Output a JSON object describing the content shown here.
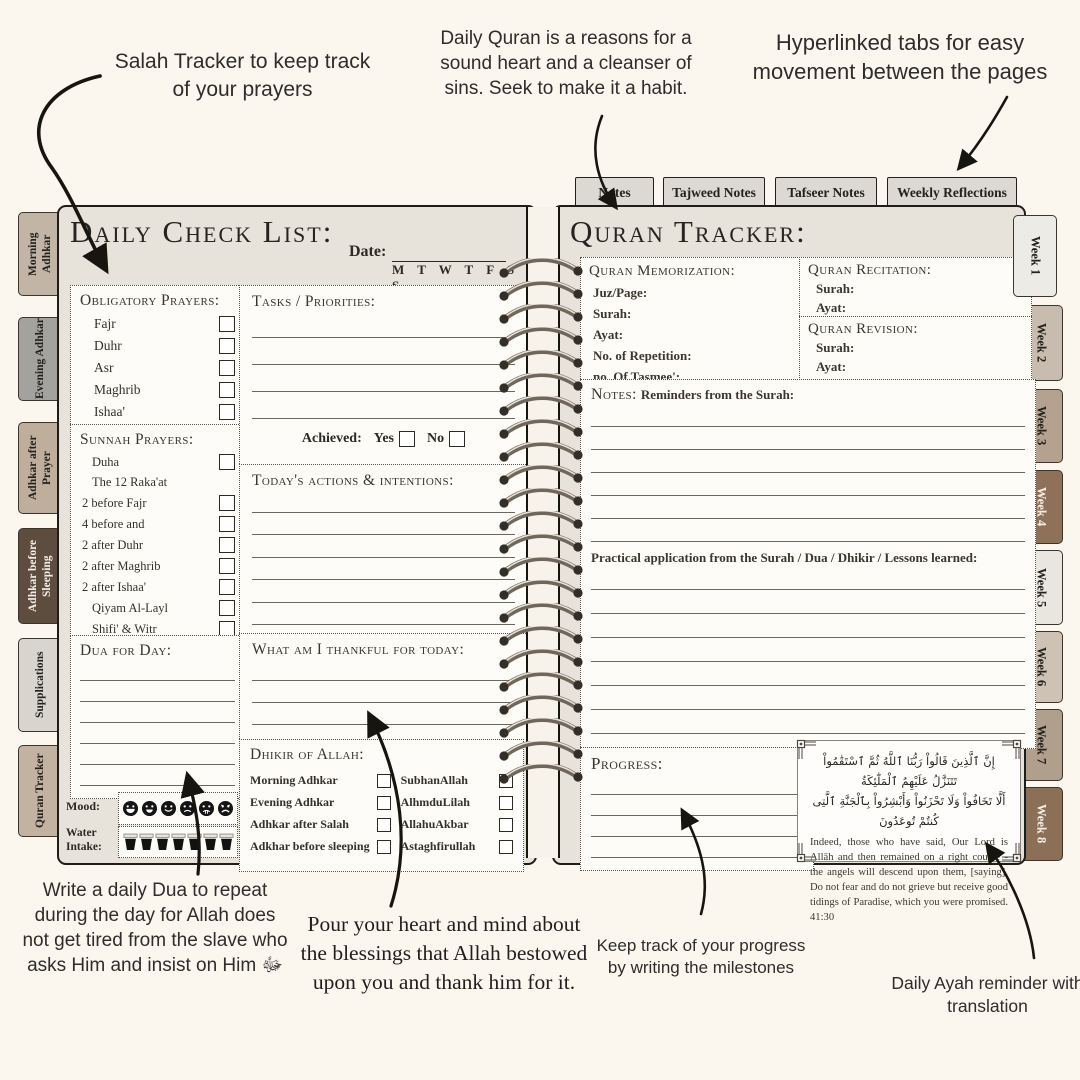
{
  "colors": {
    "background": "#fbf7ef",
    "page": "#e7e3db",
    "paper": "#fdfcf9",
    "ink": "#2d2a24",
    "tab_gray": "#dcd9d3"
  },
  "annotations": {
    "salah_tracker": "Salah Tracker to keep track of your prayers",
    "daily_quran": "Daily Quran is a reasons for a sound heart and a cleanser of sins. Seek to make it a habit.",
    "hyperlinked_tabs": "Hyperlinked tabs for easy movement between the pages",
    "daily_dua": "Write a daily Dua to repeat during the day for Allah does not get tired from the slave who asks Him and insist on Him ﷻ",
    "thankful": "Pour your heart and mind about the blessings that Allah bestowed upon you and thank him for it.",
    "progress": "Keep track of your progress by writing the milestones",
    "daily_ayah": "Daily Ayah reminder with translation"
  },
  "top_tabs": [
    "Notes",
    "Tajweed Notes",
    "Tafseer Notes",
    "Weekly Reflections"
  ],
  "left_tabs": [
    {
      "label": "Morning Adhkar",
      "color": "#c3b5a6",
      "text_color": "#23211c"
    },
    {
      "label": "Evening Adhkar",
      "color": "#a3a29e",
      "text_color": "#23211c"
    },
    {
      "label": "Adhkar after Prayer",
      "color": "#c0ae9c",
      "text_color": "#23211c"
    },
    {
      "label": "Adhkar before Sleeping",
      "color": "#5e4c3e",
      "text_color": "#f3efe8"
    },
    {
      "label": "Supplications",
      "color": "#d8d5cf",
      "text_color": "#23211c"
    },
    {
      "label": "Quran Tracker",
      "color": "#c3b2a1",
      "text_color": "#23211c"
    }
  ],
  "week_tabs": [
    {
      "label": "Week 1",
      "color": "#edebe5",
      "text_color": "#23211c"
    },
    {
      "label": "Week 2",
      "color": "#c8bcae",
      "text_color": "#23211c"
    },
    {
      "label": "Week 3",
      "color": "#b5a190",
      "text_color": "#23211c"
    },
    {
      "label": "Week 4",
      "color": "#8f7159",
      "text_color": "#f3efe8"
    },
    {
      "label": "Week 5",
      "color": "#e9e6e0",
      "text_color": "#23211c"
    },
    {
      "label": "Week 6",
      "color": "#cdc2b4",
      "text_color": "#23211c"
    },
    {
      "label": "Week 7",
      "color": "#b19f8d",
      "text_color": "#23211c"
    },
    {
      "label": "Week 8",
      "color": "#8c6f57",
      "text_color": "#f3efe8"
    }
  ],
  "left_page": {
    "title": "Daily Check List:",
    "date_label": "Date:",
    "days": "M T W T F S S",
    "obligatory": {
      "title": "Obligatory Prayers:",
      "items": [
        "Fajr",
        "Duhr",
        "Asr",
        "Maghrib",
        "Ishaa'"
      ]
    },
    "sunnah": {
      "title": "Sunnah Prayers:",
      "items": [
        "Duha",
        "The 12 Raka'at",
        "2 before Fajr",
        "4 before  and",
        "2 after Duhr",
        "2 after Maghrib",
        "2 after Ishaa'",
        "Qiyam Al-Layl",
        "Shifi' & Witr"
      ]
    },
    "dua_title": "Dua for Day:",
    "mood_label": "Mood:",
    "water_label": "Water Intake:",
    "tasks": {
      "title": "Tasks / Priorities:",
      "achieved_label": "Achieved:",
      "yes_label": "Yes",
      "no_label": "No"
    },
    "actions_title": "Today's actions & intentions:",
    "thankful_title": "What am I thankful for today:",
    "dhikir": {
      "title": "Dhikir of Allah:",
      "left": [
        "Morning Adhkar",
        "Evening Adhkar",
        "Adhkar after Salah",
        "Adkhar before sleeping"
      ],
      "right": [
        "SubhanAllah",
        "AlhmduLilah",
        "AllahuAkbar",
        "Astaghfirullah"
      ]
    }
  },
  "right_page": {
    "title": "Quran Tracker:",
    "memorization": {
      "title": "Quran Memorization:",
      "fields": [
        "Juz/Page:",
        "Surah:",
        "Ayat:",
        "No. of Repetition:",
        "no. Of Tasmee':"
      ]
    },
    "recitation": {
      "title": "Quran Recitation:",
      "fields": [
        "Surah:",
        "Ayat:"
      ]
    },
    "revision": {
      "title": "Quran Revision:",
      "fields": [
        "Surah:",
        "Ayat:"
      ]
    },
    "notes": {
      "title": "Notes:",
      "subtitle": "Reminders from the Surah:",
      "practical": "Practical application from the Surah / Dua / Dhikir  / Lessons learned:"
    },
    "progress_title": "Progress:",
    "ayah_box": {
      "arabic_line1": "إِنَّ ٱلَّذِينَ قَالُواْ رَبُّنَا ٱللَّهُ ثُمَّ ٱسْتَقَٰمُواْ تَتَنَزَّلُ عَلَيْهِمُ ٱلْمَلَٰٓئِكَةُ",
      "arabic_line2": "أَلَّا تَخَافُواْ وَلَا تَحْزَنُواْ وَأَبْشِرُواْ بِٱلْجَنَّةِ ٱلَّتِى كُنتُمْ تُوعَدُونَ",
      "english": "Indeed, those who have said, Our Lord is Allāh and then remained on a right course - the angels will descend upon them, [saying], Do not fear and do not grieve but receive good tidings of Paradise, which you were promised. 41:30"
    }
  }
}
